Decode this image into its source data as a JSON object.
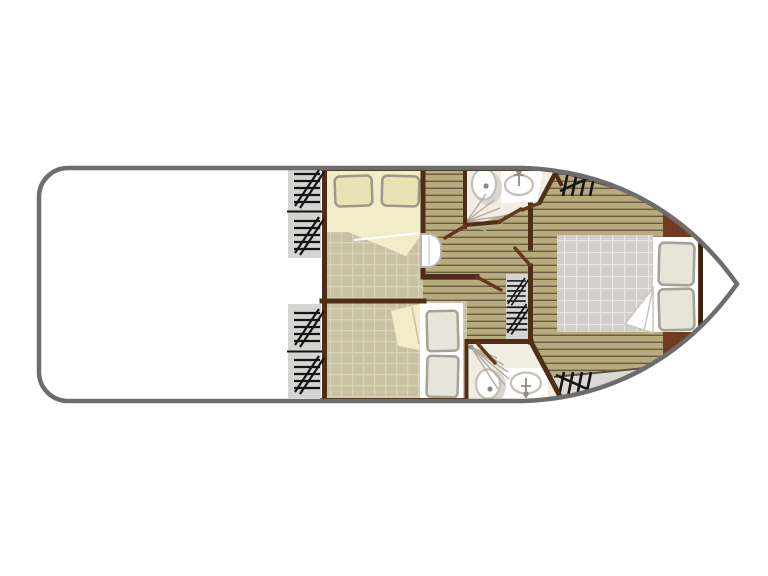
{
  "plan": {
    "kind": "boat-floor-plan",
    "orientation": "bow-right",
    "areas": [
      {
        "id": "open-deck",
        "type": "deck",
        "side": "left"
      },
      {
        "id": "deck-steps",
        "type": "steps",
        "count": 4,
        "side": "left-bulkhead"
      },
      {
        "id": "cabin-top",
        "type": "cabin",
        "bed": "double",
        "pillows": 2
      },
      {
        "id": "cabin-bottom",
        "type": "cabin",
        "bed": "double",
        "pillows": 2
      },
      {
        "id": "bathroom-top",
        "type": "bathroom",
        "fixtures": [
          "toilet",
          "washbasin",
          "shower"
        ]
      },
      {
        "id": "bathroom-bottom",
        "type": "bathroom",
        "fixtures": [
          "toilet",
          "washbasin",
          "shower"
        ]
      },
      {
        "id": "corridor",
        "type": "hallway",
        "floor": "wood-planks"
      },
      {
        "id": "companionway-stairs",
        "type": "stairs",
        "treads": 2
      },
      {
        "id": "cabin-bow",
        "type": "cabin",
        "bed": "double",
        "pillows": 2,
        "floor": "wood-planks"
      },
      {
        "id": "bow-steps-top",
        "type": "steps",
        "count": 1
      },
      {
        "id": "bow-steps-bottom",
        "type": "steps",
        "count": 1
      }
    ]
  },
  "colors": {
    "hull_outline": "#6d6d6d",
    "deck_white": "#ffffff",
    "deck_gray": "#d9d8d5",
    "stair_panel": "#d4d4d2",
    "hatch": "#141414",
    "wall": "#4f2e18",
    "door_leaf": "#5f3a1e",
    "plank_base": "#b7ab7d",
    "plank_seam": "#6a5c42",
    "plank_edge": "#5e5038",
    "cabin_floor": "#c8c2a2",
    "cabin_floor_grid": "#d8d3b9",
    "bed_cream": "#f2ecc8",
    "pillow_cream": "#e9e2b4",
    "pillow_cream_outline": "#9d988a",
    "bed_white": "#ffffff",
    "pillow_gray": "#e7e4da",
    "pillow_gray_outline": "#a6a296",
    "mattress": "#d2cec8",
    "mattress_grid": "#e9e7e3",
    "headboard": "#6f3c22",
    "headboard_edge": "#3b2312",
    "bathroom_floor": "#f1ede3",
    "fixture_fill": "#ffffff",
    "fixture_outline": "#c4c0b8",
    "fixture_shadow": "#d9d6d0",
    "toilet_dot": "#8a8a8a",
    "spray": "#b3ab9c",
    "step_unit_outline": "#b8b4ac"
  }
}
